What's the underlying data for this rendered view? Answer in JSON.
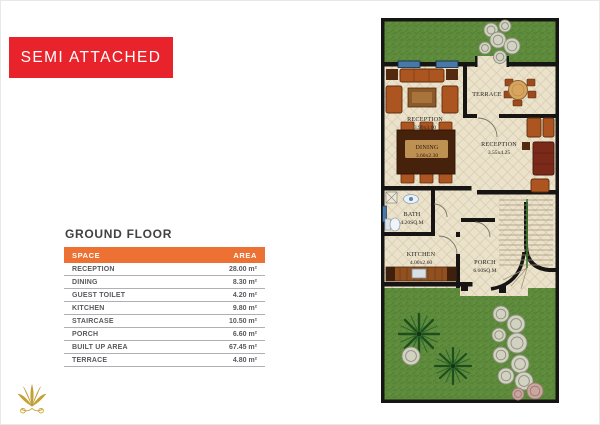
{
  "title_box": {
    "label": "SEMI ATTACHED"
  },
  "ground_floor": {
    "heading": "GROUND FLOOR",
    "columns": {
      "space": "SPACE",
      "area": "AREA"
    },
    "rows": [
      {
        "space": "RECEPTION",
        "area": "28.00 m²"
      },
      {
        "space": "DINING",
        "area": "8.30 m²"
      },
      {
        "space": "GUEST TOILET",
        "area": "4.20 m²"
      },
      {
        "space": "KITCHEN",
        "area": "9.80 m²"
      },
      {
        "space": "STAIRCASE",
        "area": "10.50 m²"
      },
      {
        "space": "PORCH",
        "area": "6.60 m²"
      },
      {
        "space": "BUILT UP AREA",
        "area": "67.45 m²"
      },
      {
        "space": "TERRACE",
        "area": "4.80 m²"
      }
    ]
  },
  "plan": {
    "rooms": {
      "reception_front": {
        "name": "RECEPTION",
        "dims": "3.90x3.60"
      },
      "terrace": {
        "name": "TERRACE"
      },
      "reception_side": {
        "name": "RECEPTION",
        "dims": "3.55x4.25"
      },
      "dining": {
        "name": "DINING",
        "dims": "3.60x2.30"
      },
      "bath": {
        "name": "BATH",
        "dims": "4.20SQ.M"
      },
      "kitchen": {
        "name": "KITCHEN",
        "dims": "4.00x2.60"
      },
      "porch": {
        "name": "PORCH",
        "dims": "6.60SQ.M"
      }
    }
  },
  "colors": {
    "accent_red": "#E8232B",
    "accent_orange": "#ED7133",
    "grass_green": "#5E8C3C",
    "wall_black": "#171513",
    "floor_cream": "#EBE2CC",
    "furniture_orange": "#AC5520",
    "logo_gold": "#C8A02E"
  }
}
